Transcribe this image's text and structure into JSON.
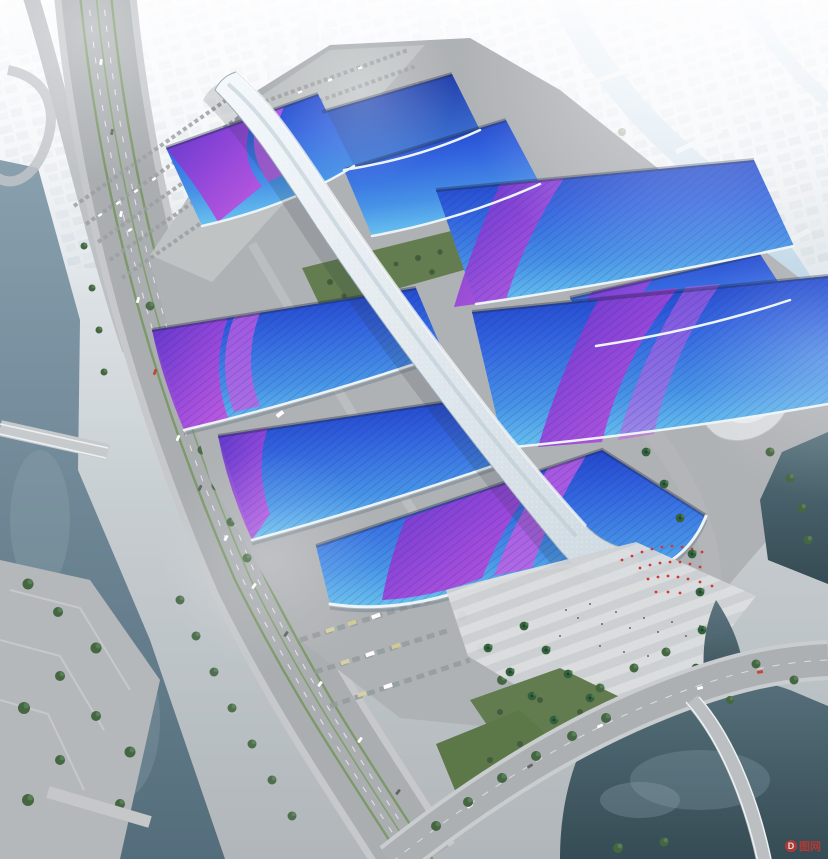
{
  "watermark": {
    "logo_letter": "D",
    "text": "图网",
    "color": "#d0342c"
  },
  "scene": {
    "type": "aerial-architectural-rendering",
    "subject": "Large riverside exhibition and convention center with a white serpentine central spine roof and rows of blue exhibition halls crossed by purple-magenta ribbon patterns",
    "environment": [
      "hazy white city skyline",
      "winding light-blue river at top right",
      "canal with terraced banks at left",
      "multi-lane highway",
      "dark water and bridges at bottom right",
      "south entrance plaza with palm trees and red banners"
    ],
    "halls_visible": 9,
    "spine": "white quilted ribbon running the full length of the site, ending in a curled head over the south entrance hall"
  },
  "palette": {
    "haze": "#eef2f4",
    "concrete": "#aeb1b3",
    "road": "#a9adaf",
    "hall_blue_deep": "#1030c0",
    "hall_blue": "#2f6fe0",
    "hall_cyan": "#5fb4ea",
    "roof_purple": "#7a35d2",
    "roof_magenta": "#c653e2",
    "spine_white": "#f2f7fa",
    "courtyard_green": "#5c7847",
    "foliage": "#3c6038",
    "water_canal": "#516c7a",
    "water_dark": "#2c434c",
    "flag_red": "#cf3026"
  }
}
